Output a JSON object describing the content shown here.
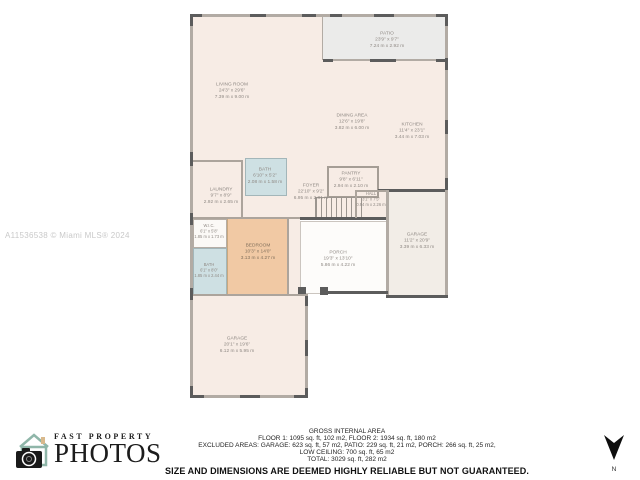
{
  "watermark": "A11536538 © Miami MLS® 2024",
  "logo": {
    "top_text": "FAST PROPERTY",
    "bottom_text": "PHOTOS"
  },
  "compass": {
    "label": "N"
  },
  "rooms": {
    "patio": {
      "name": "PATIO",
      "ft": "23'9\" x 9'7\"",
      "m": "7.24 m x 2.92 m"
    },
    "living_room": {
      "name": "LIVING ROOM",
      "ft": "24'3\" x 29'6\"",
      "m": "7.39 m x 9.00 m"
    },
    "dining_area": {
      "name": "DINING AREA",
      "ft": "12'6\" x 19'8\"",
      "m": "3.82 m x 6.00 m"
    },
    "kitchen": {
      "name": "KITCHEN",
      "ft": "11'4\" x 23'1\"",
      "m": "3.44 m x 7.03 m"
    },
    "bath_upper": {
      "name": "BATH",
      "ft": "6'10\" x 5'2\"",
      "m": "2.08 m x 1.58 m"
    },
    "laundry": {
      "name": "LAUNDRY",
      "ft": "9'7\" x 8'9\"",
      "m": "2.92 m x 2.65 m"
    },
    "foyer": {
      "name": "FOYER",
      "ft": "22'10\" x 9'2\"",
      "m": "6.95 m x 2.81 m"
    },
    "pantry": {
      "name": "PANTRY",
      "ft": "9'8\" x 6'11\"",
      "m": "2.94 m x 2.10 m"
    },
    "hall": {
      "name": "HALL",
      "ft": "3'1\" x 7'5\"",
      "m": "0.94 m x 2.26 m"
    },
    "wic": {
      "name": "W.I.C.",
      "ft": "6'1\" x 5'8\"",
      "m": "1.85 m x 1.73 m"
    },
    "bedroom": {
      "name": "BEDROOM",
      "ft": "10'3\" x 14'0\"",
      "m": "3.13 m x 4.27 m"
    },
    "bath_lower": {
      "name": "BATH",
      "ft": "6'1\" x 8'0\"",
      "m": "1.85 m x 2.44 m"
    },
    "porch": {
      "name": "PORCH",
      "ft": "19'3\" x 13'10\"",
      "m": "5.86 m x 4.22 m"
    },
    "garage_right": {
      "name": "GARAGE",
      "ft": "11'2\" x 20'9\"",
      "m": "3.39 m x 6.33 m"
    },
    "garage_main": {
      "name": "GARAGE",
      "ft": "20'1\" x 19'6\"",
      "m": "6.12 m x 5.95 m"
    }
  },
  "footer": {
    "line1": "GROSS INTERNAL AREA",
    "line2": "FLOOR 1: 1095 sq. ft, 102 m2, FLOOR 2: 1934 sq. ft, 180 m2",
    "line3": "EXCLUDED AREAS: GARAGE: 623 sq. ft, 57 m2, PATIO: 229 sq. ft, 21 m2, PORCH: 266 sq. ft, 25 m2,",
    "line4": "LOW CEILING: 700 sq. ft, 65 m2",
    "line5": "TOTAL: 3029 sq. ft, 282 m2",
    "disclaimer": "SIZE AND DIMENSIONS ARE DEEMED HIGHLY RELIABLE BUT NOT GUARANTEED."
  },
  "colors": {
    "floor_cream": "#f7ece5",
    "patio_gray": "#ebebea",
    "bedroom_tan": "#f1c9a4",
    "bath_blue": "#cee0e3",
    "wall_dark": "#5c5c5c",
    "wall_light": "#b2aba4",
    "label_gray": "#8f8984",
    "logo_teal": "#8fb6a9",
    "watermark_gray": "#c9c9c9"
  }
}
